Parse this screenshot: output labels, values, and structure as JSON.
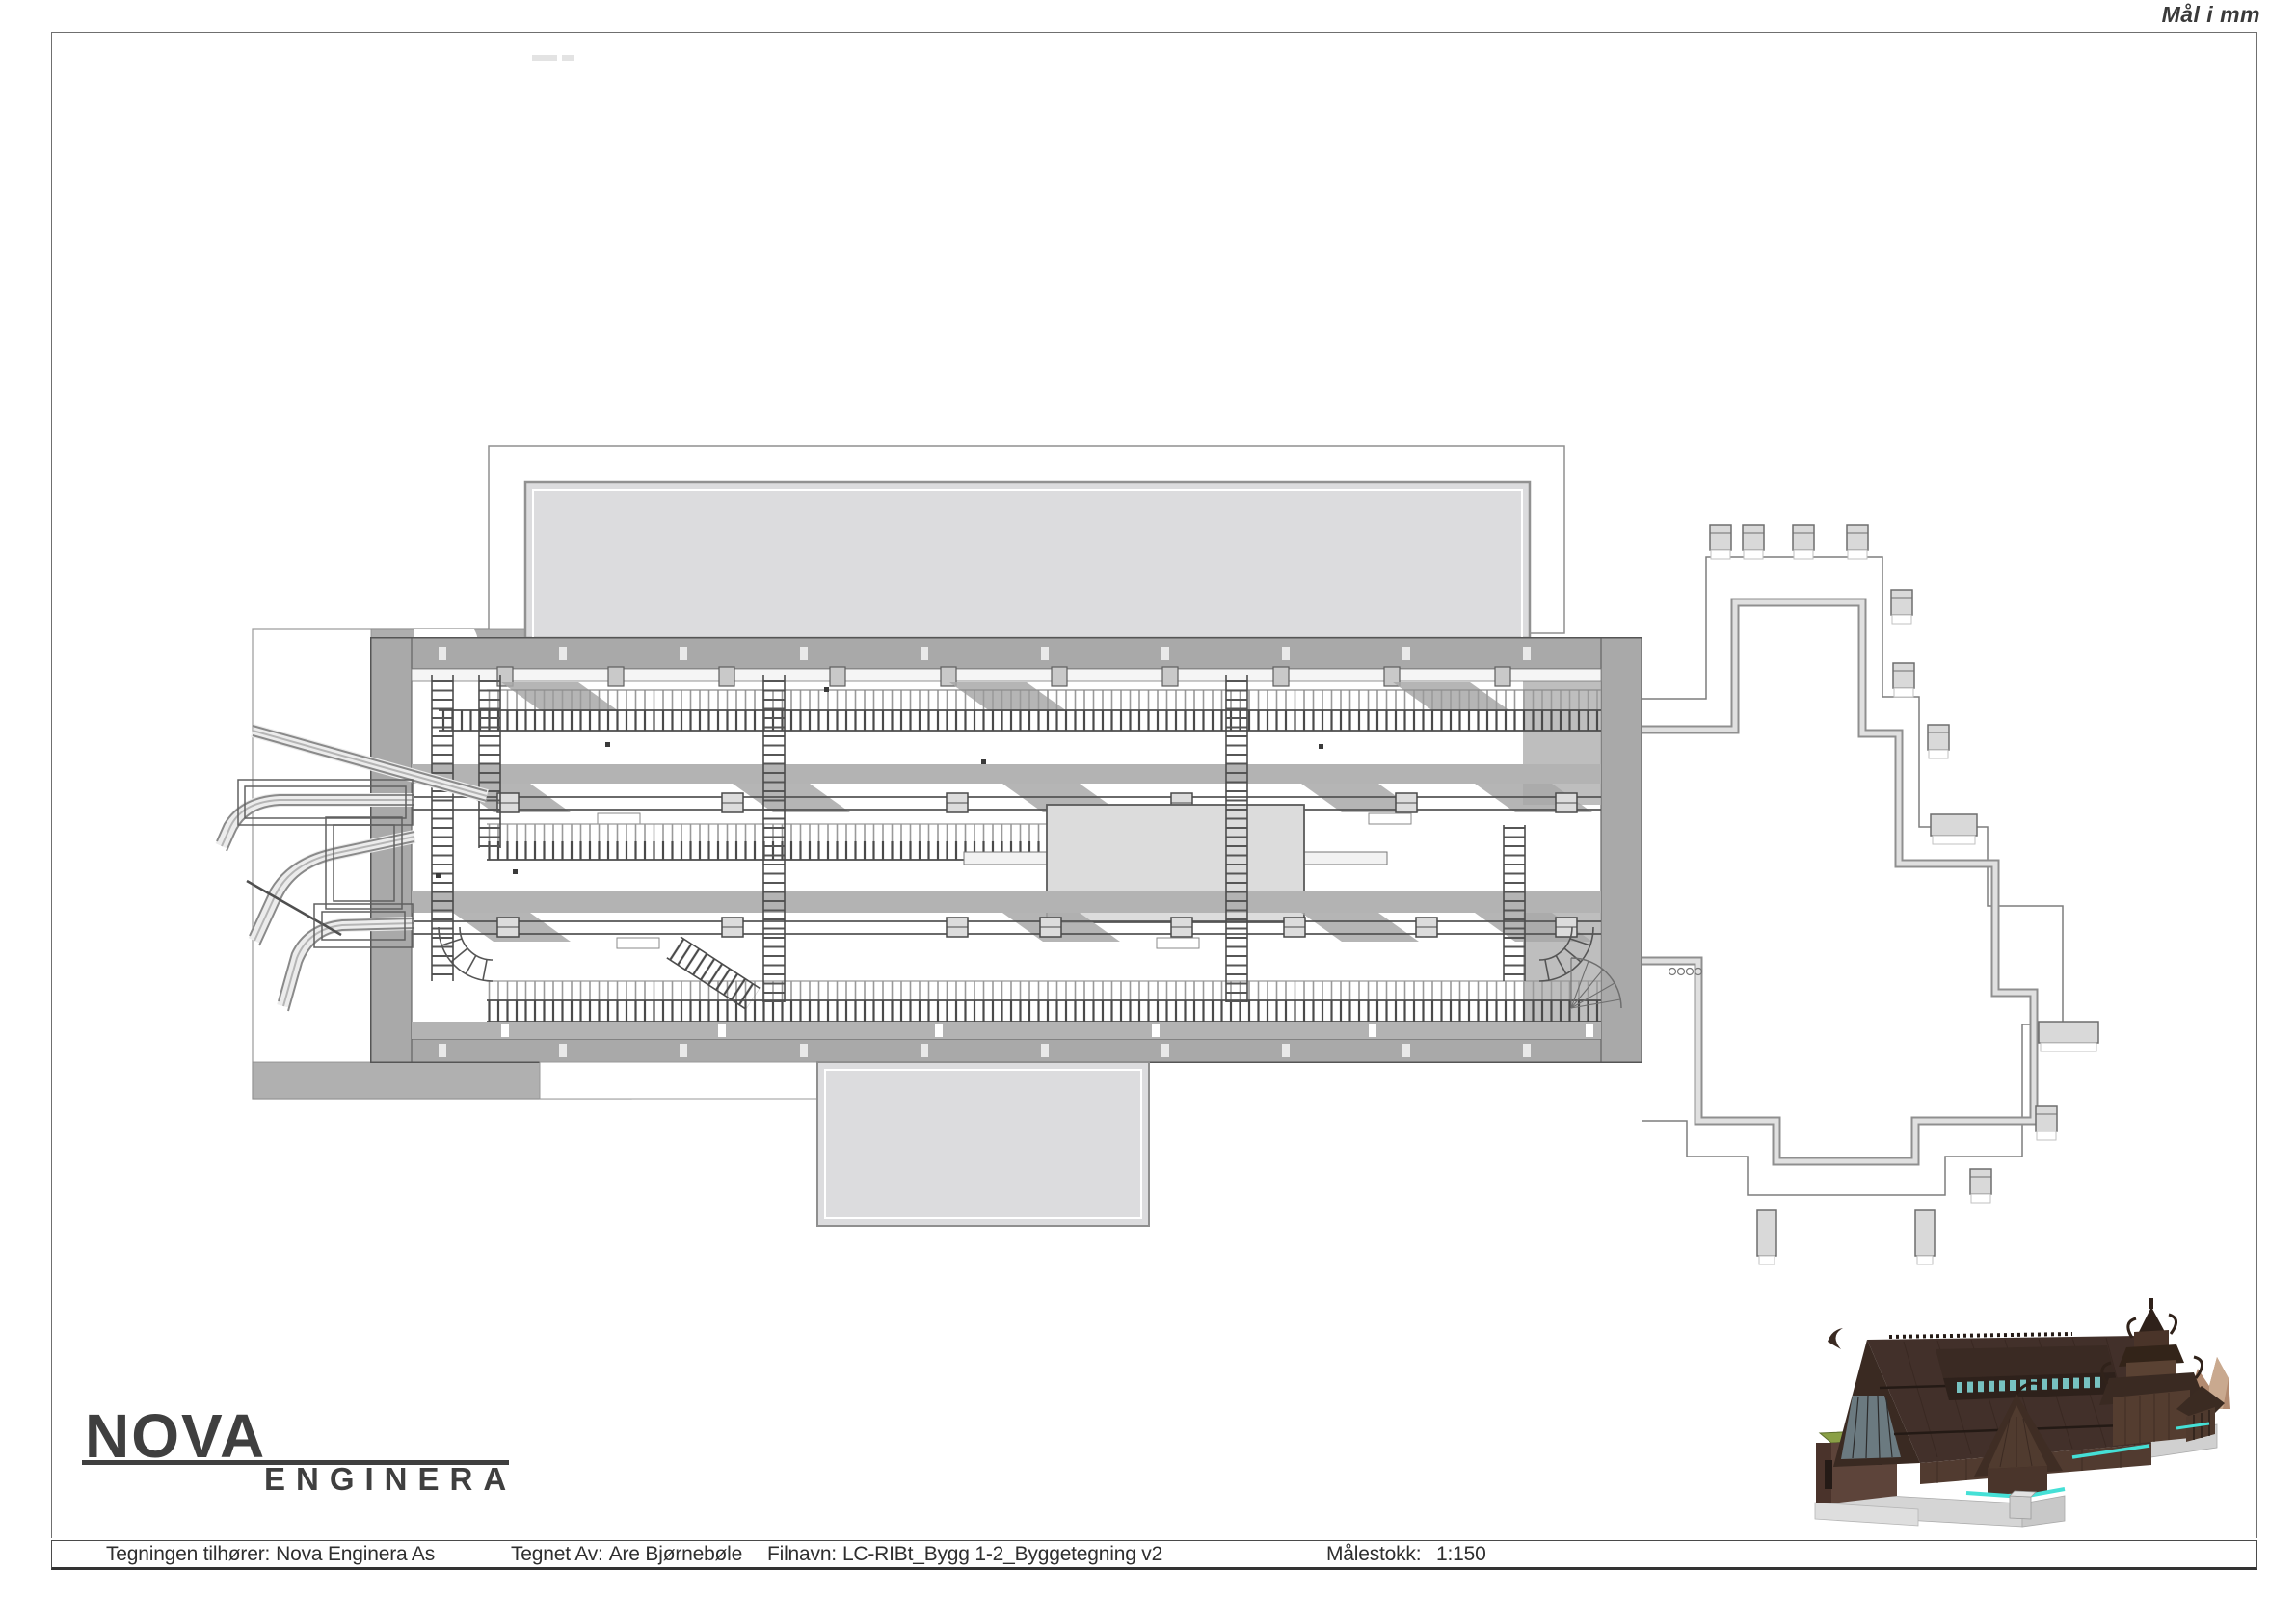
{
  "sheet": {
    "units_note": "Mål i mm"
  },
  "logo": {
    "primary": "NOVA",
    "secondary": "ENGINERA"
  },
  "title_block": {
    "owner_label": "Tegningen tilhører:",
    "owner": "Nova Enginera As",
    "drawn_by_label": "Tegnet Av:",
    "drawn_by": "Are Bjørnebøle",
    "filename_label": "Filnavn:",
    "filename": "LC-RIBt_Bygg 1-2_Byggetegning v2",
    "scale_label": "Målestokk:",
    "scale": "1:150"
  },
  "plan": {
    "colors": {
      "wall": "#a9a9a9",
      "slab": "#dcdcde",
      "band": "#b3b3b3",
      "line": "#5e5e5e",
      "outline": "#8f8f8f"
    }
  },
  "render": {
    "colors": {
      "roof": "#42302a",
      "wall": "#543d30",
      "grass_roof": "#8aa046",
      "concrete": "#d5d5d5",
      "accent": "#45e0d6",
      "mountain": "#b28a70"
    }
  }
}
